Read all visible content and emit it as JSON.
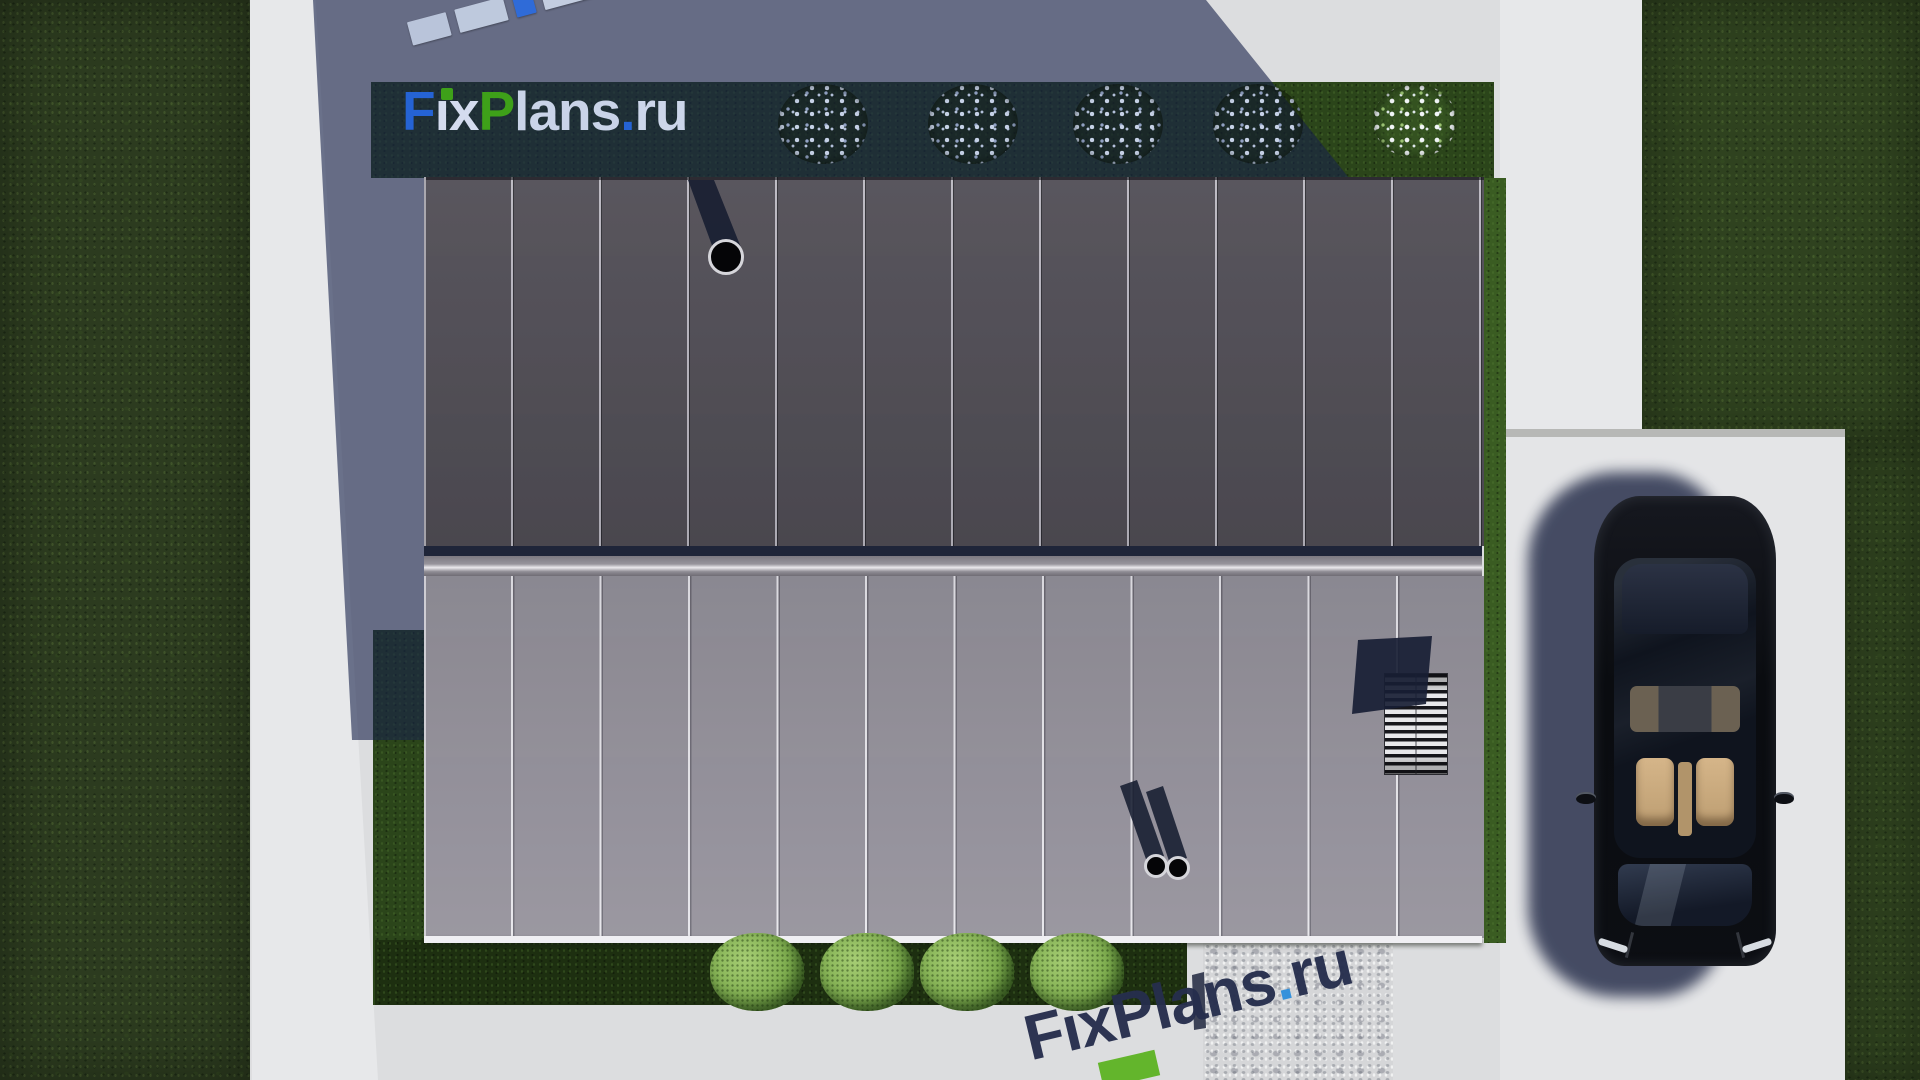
{
  "brand": {
    "site_name": "FixPlans.ru",
    "top_logo_parts": [
      {
        "text": "F",
        "color": "#2563d4"
      },
      {
        "text": "ı",
        "color": "#d4dcef"
      },
      {
        "text": "x",
        "color": "#d4dcef"
      },
      {
        "text": "P",
        "color": "#3ea019"
      },
      {
        "text": "lans",
        "color": "#c9d3e8"
      },
      {
        "text": ".",
        "color": "#2563d4"
      },
      {
        "text": "ru",
        "color": "#ccd6ea"
      }
    ],
    "bottom_watermark_parts": [
      {
        "text": "F",
        "color": "#262e4d"
      },
      {
        "text": "ı",
        "color": "#262e4d"
      },
      {
        "text": "x",
        "color": "#262e4d"
      },
      {
        "text": "P",
        "color": "#262e4d"
      },
      {
        "text": "lans",
        "color": "#262e4d"
      },
      {
        "text": ".",
        "color": "#2f8fdc"
      },
      {
        "text": "ru",
        "color": "#262e4d"
      }
    ],
    "bar_segments": [
      {
        "w": 40,
        "color": "#b9c4da"
      },
      {
        "w": 50,
        "color": "#bec9dd"
      },
      {
        "w": 20,
        "color": "#2f6bd8"
      },
      {
        "w": 56,
        "color": "#c3cde0"
      },
      {
        "w": 42,
        "color": "#b9c4da"
      },
      {
        "w": 30,
        "color": "#3ba01e"
      },
      {
        "w": 24,
        "color": "#c6d0e2"
      },
      {
        "w": 20,
        "color": "#2f6bd8"
      }
    ]
  },
  "palette": {
    "pavement": "#dcdddf",
    "pavement-bright": "#e4e5e7",
    "concrete-path": "#e7e8ea",
    "grass": "#2c3b1f",
    "grass-right": "#2f421f",
    "garden-dark": "#1d2f10",
    "garden-lit": "#2b451a",
    "garden-strip-lit": "#3a5c22",
    "roof-dark": "#504d55",
    "roof-light": "#93909a",
    "ridge-highlight": "#eceaee",
    "navy": "#1f2539",
    "eave": "#f0eff3",
    "building-shadow": "rgba(24,34,74,0.60)"
  },
  "scene": {
    "description": "Top-down 3D render of a house with standing-seam two-tone roof, driveway with black car, lawns, flower bushes and FixPlans.ru watermarks",
    "roof": {
      "panel_count": 12,
      "sections": [
        "dark upper slope",
        "light lower slope"
      ]
    },
    "top_bushes": [
      {
        "cx": 823,
        "cy": 124,
        "r": 45,
        "lit": false
      },
      {
        "cx": 973,
        "cy": 124,
        "r": 45,
        "lit": false
      },
      {
        "cx": 1118,
        "cy": 124,
        "r": 45,
        "lit": false
      },
      {
        "cx": 1258,
        "cy": 124,
        "r": 45,
        "lit": false
      },
      {
        "cx": 1415,
        "cy": 121,
        "r": 42,
        "lit": true
      }
    ],
    "bottom_bushes": [
      {
        "cx": 757,
        "cy": 972,
        "r": 47
      },
      {
        "cx": 867,
        "cy": 972,
        "r": 47
      },
      {
        "cx": 967,
        "cy": 972,
        "r": 47
      },
      {
        "cx": 1077,
        "cy": 972,
        "r": 47
      }
    ],
    "pipes": {
      "chimney": {
        "cx": 726,
        "cy": 257,
        "r": 18
      },
      "vents": [
        {
          "cx": 1156,
          "cy": 866,
          "r": 12
        },
        {
          "cx": 1178,
          "cy": 868,
          "r": 12
        }
      ]
    },
    "car": {
      "body_color": "#0b0d12",
      "interior_color": "#c7a87d",
      "position": "driveway right side, facing down"
    }
  }
}
